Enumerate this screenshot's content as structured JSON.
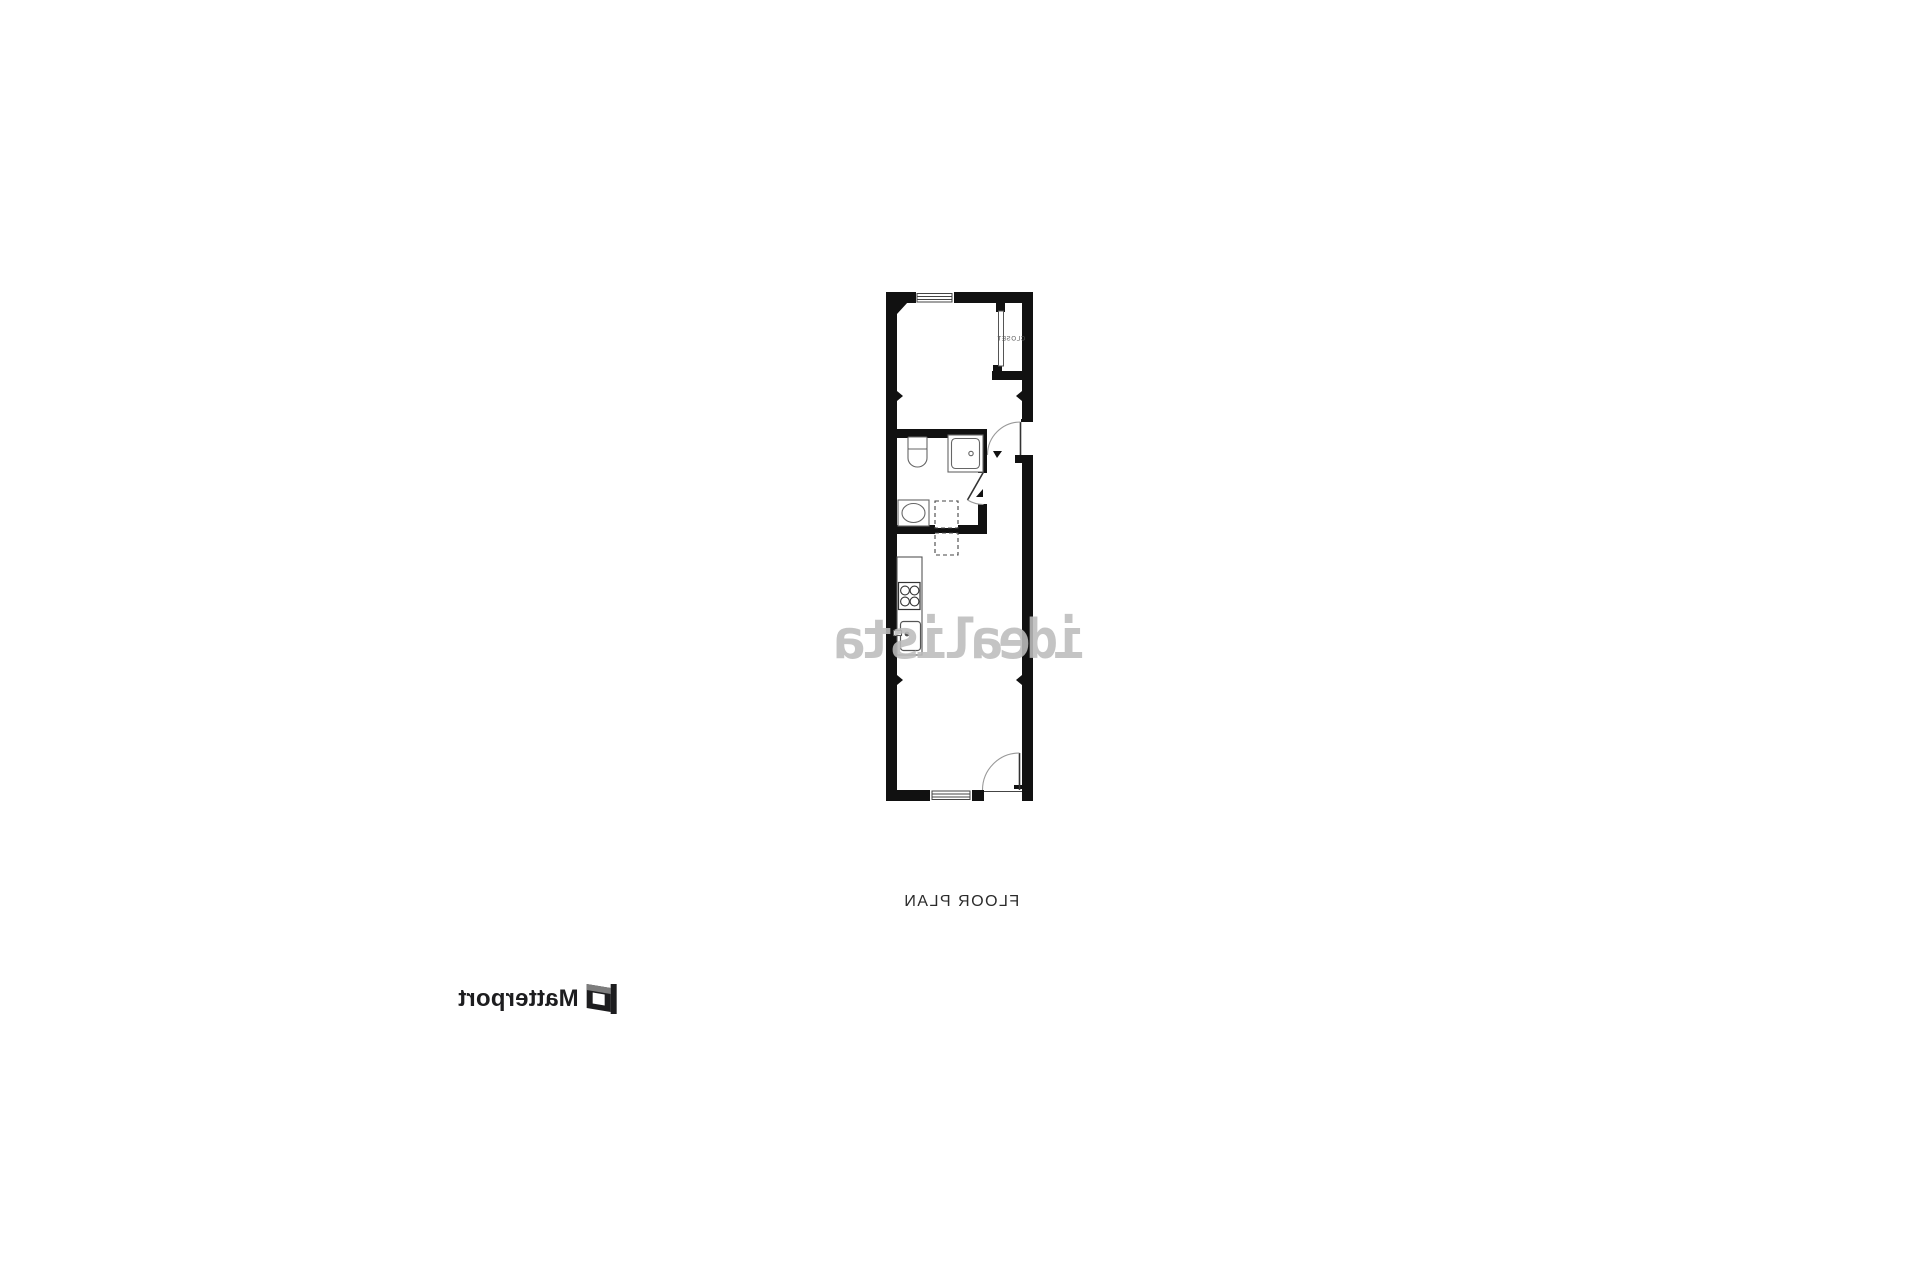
{
  "page": {
    "background": "#ffffff"
  },
  "floor_plan": {
    "caption": "FLOOR PLAN",
    "watermark": "idealista",
    "labels": {
      "closet": "CLOSET"
    },
    "colors": {
      "wall": "#111111",
      "fixture": "#666666",
      "door": "#333333",
      "arc": "#999999",
      "label": "#555555",
      "caption_text": "#2b2b2b",
      "watermark_gray": "#bdbdbd"
    },
    "features": [
      "closet with sliding door",
      "entry door with swing arc",
      "bathroom: toilet, shower, washing machine, dashed appliance boxes",
      "kitchen: counter, 4-burner stove, sink",
      "top window",
      "bottom window",
      "bottom door with swing arc"
    ]
  },
  "branding": {
    "logo_text": "Matterport",
    "logo_color": "#1d1d1f"
  }
}
